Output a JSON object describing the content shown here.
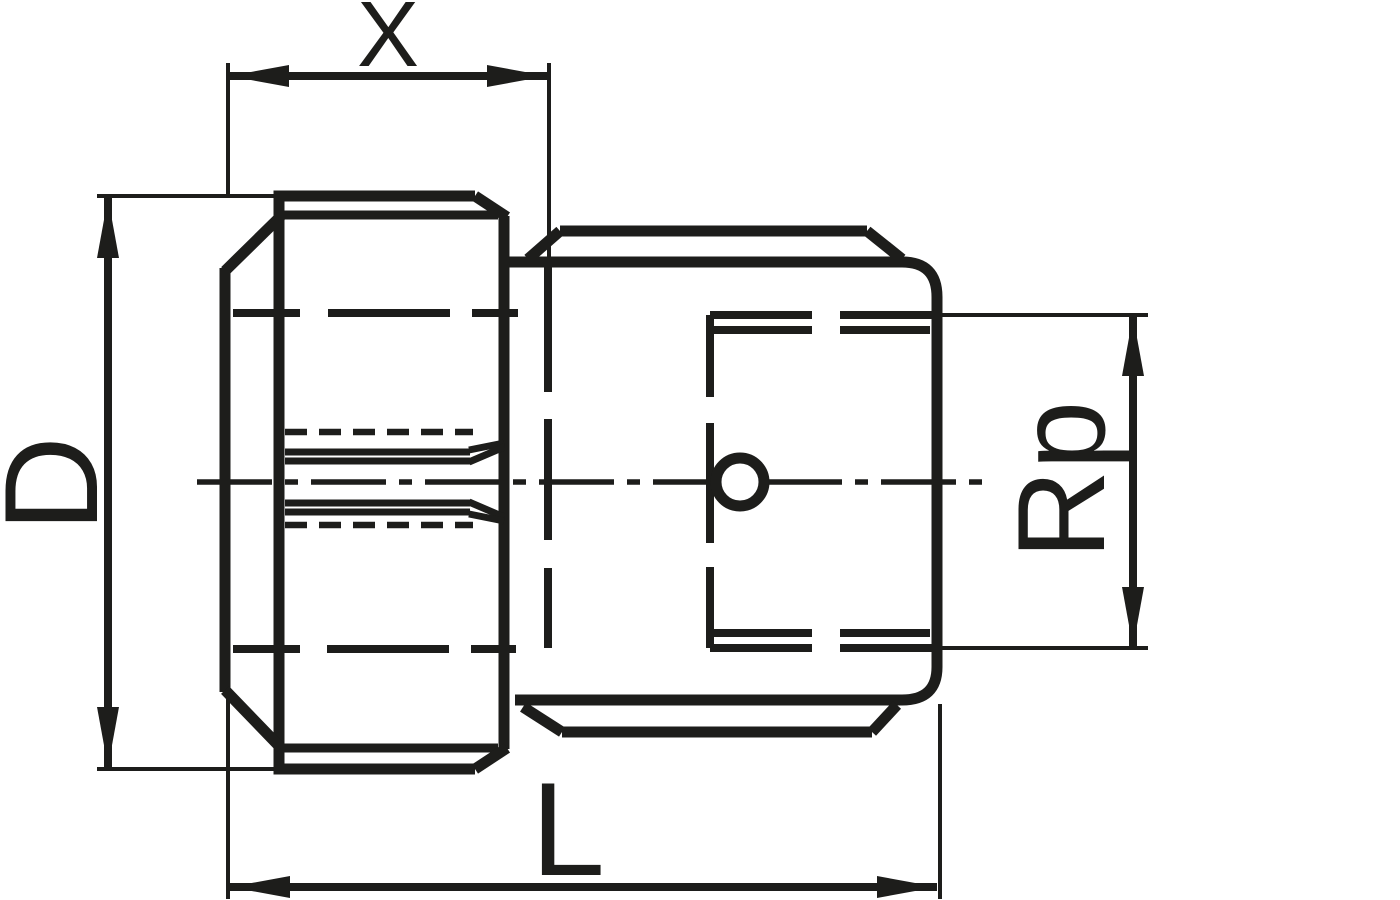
{
  "drawing": {
    "dimensions": {
      "x": {
        "label": "X"
      },
      "d": {
        "label": "D"
      },
      "l": {
        "label": "L"
      },
      "rp": {
        "label": "Rp"
      }
    },
    "colors": {
      "ink": "#1d1d1b",
      "background": "#ffffff"
    }
  }
}
